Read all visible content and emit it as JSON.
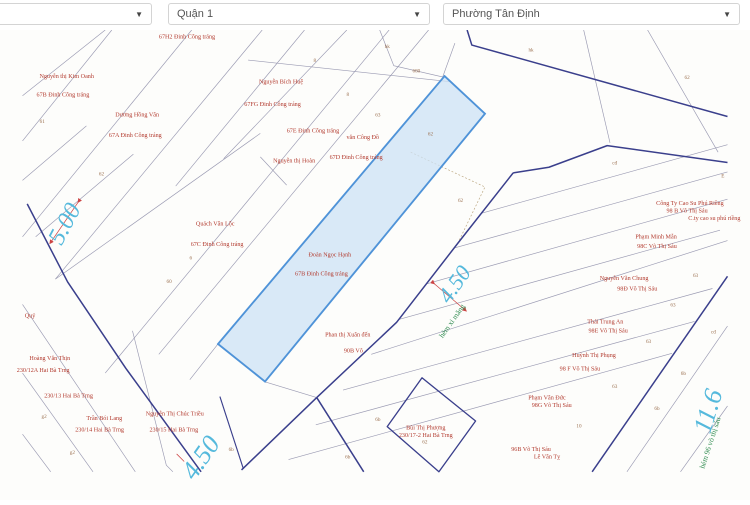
{
  "toolbar": {
    "caret": "▼",
    "selects": [
      {
        "name": "province-select",
        "value": ""
      },
      {
        "name": "district-select",
        "value": "Quận 1"
      },
      {
        "name": "ward-select",
        "value": "Phường Tân Định"
      }
    ]
  },
  "map": {
    "highlighted_parcel": {
      "owner": "Đoàn Ngọc Hạnh",
      "address": "67B Đinh Công tráng"
    },
    "colors": {
      "owner_label": "#b23a2e",
      "parcel_number": "#9b7050",
      "dimension": "#55b9dc",
      "street_name": "#2f8b4f",
      "highlight_fill": "#cce1f6",
      "highlight_stroke": "#4f93d8",
      "boundary_navy": "#3a3f8c",
      "parcel_line": "#9a9ab2"
    },
    "owner_labels": [
      {
        "text": "67H2 Đinh Công tráng",
        "x": 175,
        "y": 39
      },
      {
        "text": "Nguyễn thị Kim Oanh",
        "x": 47,
        "y": 81
      },
      {
        "text": "67B Đinh Công tráng",
        "x": 43,
        "y": 101
      },
      {
        "text": "Dương Hồng Vân",
        "x": 122,
        "y": 122
      },
      {
        "text": "67A Đinh Công tráng",
        "x": 120,
        "y": 144
      },
      {
        "text": "Nguyễn Bích Huệ",
        "x": 275,
        "y": 87
      },
      {
        "text": "67FG Đinh Công tráng",
        "x": 266,
        "y": 111
      },
      {
        "text": "67E Đinh Công tráng",
        "x": 309,
        "y": 139
      },
      {
        "text": "Nguyễn thị Hoàn",
        "x": 289,
        "y": 171
      },
      {
        "text": "văn Công Đồ",
        "x": 362,
        "y": 146
      },
      {
        "text": "67D Đinh Công tráng",
        "x": 355,
        "y": 167
      },
      {
        "text": "Quách Văn Lộc",
        "x": 205,
        "y": 238
      },
      {
        "text": "67C Đinh Công tráng",
        "x": 207,
        "y": 260
      },
      {
        "text": "Đoàn Ngọc Hạnh",
        "x": 327,
        "y": 271
      },
      {
        "text": "67B Đinh Công tráng",
        "x": 318,
        "y": 291
      },
      {
        "text": "Phan thị Xuân đến",
        "x": 346,
        "y": 356
      },
      {
        "text": "90B Võ",
        "x": 352,
        "y": 373
      },
      {
        "text": "Quý",
        "x": 8,
        "y": 336
      },
      {
        "text": "Hoàng Văn Thịn",
        "x": 29,
        "y": 381
      },
      {
        "text": "230/12A Hai Bà Trng",
        "x": 22,
        "y": 394
      },
      {
        "text": "230/13 Hai Bà Trng",
        "x": 49,
        "y": 421
      },
      {
        "text": "Trần Bói Lang",
        "x": 87,
        "y": 445
      },
      {
        "text": "230/14 Hai Bà Trng",
        "x": 82,
        "y": 457
      },
      {
        "text": "Nguyễn Thị Chúc Triều",
        "x": 162,
        "y": 440
      },
      {
        "text": "230/15 Hai Bà Trng",
        "x": 161,
        "y": 457
      },
      {
        "text": "Bùi Thị Phượng",
        "x": 429,
        "y": 455
      },
      {
        "text": "230/17-2 Hai Bà Trng",
        "x": 429,
        "y": 463
      },
      {
        "text": "Công Ty Cao Su Phú Riềng",
        "x": 710,
        "y": 216
      },
      {
        "text": "98 B Võ Thị Sáu",
        "x": 707,
        "y": 224
      },
      {
        "text": "C.ty cao su phú riềng",
        "x": 736,
        "y": 232
      },
      {
        "text": "Phạm Minh Mẫn",
        "x": 674,
        "y": 252
      },
      {
        "text": "98C Võ Thị Sáu",
        "x": 675,
        "y": 262
      },
      {
        "text": "Nguyễn Văn Chung",
        "x": 640,
        "y": 296
      },
      {
        "text": "98Đ Võ Thị Sáu",
        "x": 654,
        "y": 307
      },
      {
        "text": "Thái Trung An",
        "x": 620,
        "y": 342
      },
      {
        "text": "98E Võ Thị Sáu",
        "x": 623,
        "y": 352
      },
      {
        "text": "Huỳnh Thị Phụng",
        "x": 608,
        "y": 378
      },
      {
        "text": "98 F Võ Thị Sáu",
        "x": 593,
        "y": 392
      },
      {
        "text": "Phạm Văn Đức",
        "x": 558,
        "y": 423
      },
      {
        "text": "98G Võ Thị Sáu",
        "x": 563,
        "y": 431
      },
      {
        "text": "96B Võ Thị Sáu",
        "x": 541,
        "y": 478
      },
      {
        "text": "Lê Văn Tỵ",
        "x": 558,
        "y": 486
      }
    ],
    "parcel_numbers": [
      {
        "text": "61",
        "x": 21,
        "y": 129
      },
      {
        "text": "62",
        "x": 84,
        "y": 185
      },
      {
        "text": "8",
        "x": 311,
        "y": 64
      },
      {
        "text": "8",
        "x": 346,
        "y": 100
      },
      {
        "text": "63",
        "x": 378,
        "y": 122
      },
      {
        "text": "hk",
        "x": 388,
        "y": 49
      },
      {
        "text": "680",
        "x": 419,
        "y": 75
      },
      {
        "text": "62",
        "x": 434,
        "y": 142
      },
      {
        "text": "6",
        "x": 179,
        "y": 274
      },
      {
        "text": "60",
        "x": 156,
        "y": 299
      },
      {
        "text": "62",
        "x": 466,
        "y": 213
      },
      {
        "text": "hk",
        "x": 541,
        "y": 53
      },
      {
        "text": "62",
        "x": 707,
        "y": 82
      },
      {
        "text": "cđ",
        "x": 630,
        "y": 173
      },
      {
        "text": "E",
        "x": 745,
        "y": 187
      },
      {
        "text": "63",
        "x": 716,
        "y": 293
      },
      {
        "text": "63",
        "x": 692,
        "y": 324
      },
      {
        "text": "63",
        "x": 666,
        "y": 363
      },
      {
        "text": "cđ",
        "x": 735,
        "y": 353
      },
      {
        "text": "6b",
        "x": 703,
        "y": 397
      },
      {
        "text": "63",
        "x": 630,
        "y": 411
      },
      {
        "text": "10",
        "x": 592,
        "y": 453
      },
      {
        "text": "6b",
        "x": 675,
        "y": 434
      },
      {
        "text": "62",
        "x": 428,
        "y": 470
      },
      {
        "text": "6b",
        "x": 378,
        "y": 446
      },
      {
        "text": "6b",
        "x": 346,
        "y": 486
      },
      {
        "text": "6b",
        "x": 222,
        "y": 478
      },
      {
        "text": "g2",
        "x": 23,
        "y": 443
      },
      {
        "text": "g2",
        "x": 53,
        "y": 481
      }
    ],
    "dimension_labels": [
      {
        "text": "5.00",
        "x": 52,
        "y": 240,
        "rotate": -62,
        "size": 26
      },
      {
        "text": "4.50",
        "x": 466,
        "y": 305,
        "rotate": -55,
        "size": 24
      },
      {
        "text": "4.50",
        "x": 197,
        "y": 490,
        "rotate": -55,
        "size": 28
      },
      {
        "text": "11.6",
        "x": 738,
        "y": 438,
        "rotate": -73,
        "size": 28
      }
    ],
    "street_labels": [
      {
        "text": "hẻm xi măng",
        "x": 459,
        "y": 341,
        "rotate": -55
      },
      {
        "text": "hẻm 96 võ thị sáu",
        "x": 734,
        "y": 470,
        "rotate": -72
      }
    ]
  }
}
